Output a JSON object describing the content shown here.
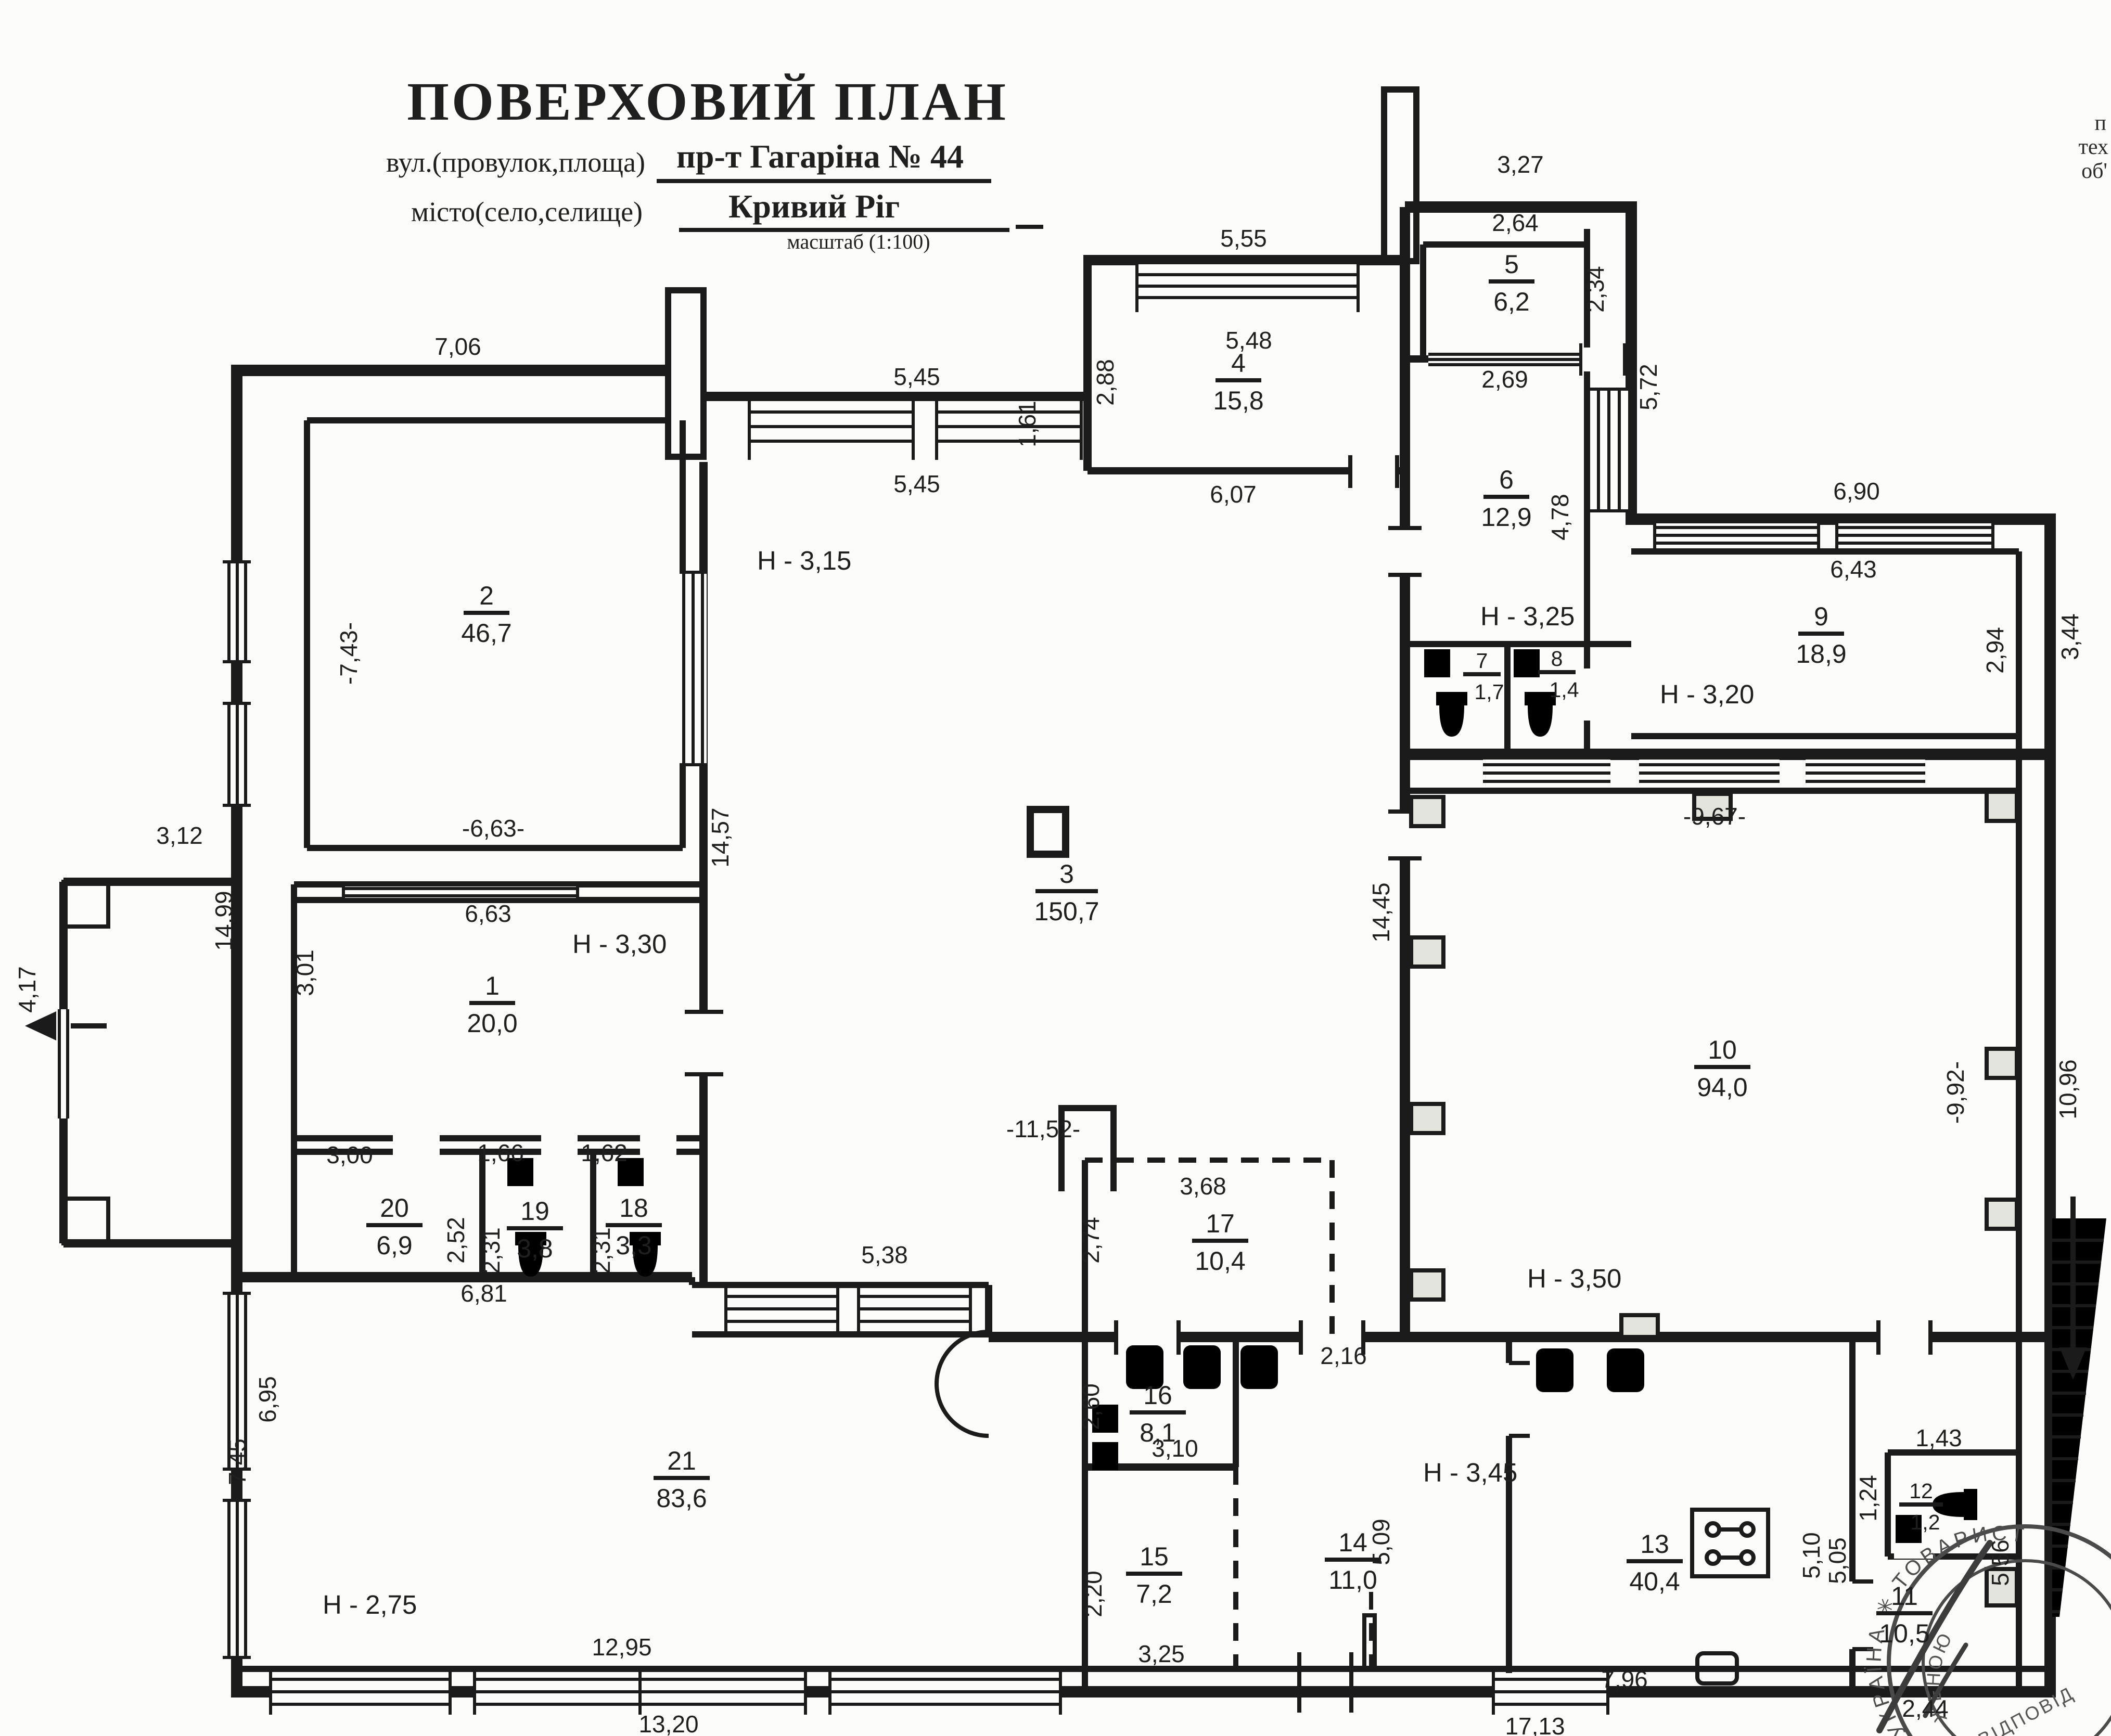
{
  "title_block": {
    "title": "ПОВЕРХОВИЙ ПЛАН",
    "street_label": "вул.(провулок,площа)",
    "street_value": "пр-т Гагаріна  №  44",
    "city_label": "місто(село,селище)",
    "city_value": "Кривий Ріг",
    "scale_note": "масштаб (1:100)"
  },
  "corner_note": {
    "line1": "п",
    "line2": "тех",
    "line3": "об'"
  },
  "rooms": {
    "r1": {
      "num": "1",
      "area": "20,0"
    },
    "r2": {
      "num": "2",
      "area": "46,7"
    },
    "r3": {
      "num": "3",
      "area": "150,7"
    },
    "r4": {
      "num": "4",
      "area": "15,8"
    },
    "r5": {
      "num": "5",
      "area": "6,2"
    },
    "r6": {
      "num": "6",
      "area": "12,9"
    },
    "r7": {
      "num": "7",
      "area": "1,7"
    },
    "r8": {
      "num": "8",
      "area": "1,4"
    },
    "r9": {
      "num": "9",
      "area": "18,9"
    },
    "r10": {
      "num": "10",
      "area": "94,0"
    },
    "r11": {
      "num": "11",
      "area": "10,5"
    },
    "r12": {
      "num": "12",
      "area": "1,2"
    },
    "r13": {
      "num": "13",
      "area": "40,4"
    },
    "r14": {
      "num": "14",
      "area": "11,0"
    },
    "r15": {
      "num": "15",
      "area": "7,2"
    },
    "r16": {
      "num": "16",
      "area": "8,1"
    },
    "r17": {
      "num": "17",
      "area": "10,4"
    },
    "r18": {
      "num": "18",
      "area": "3,3"
    },
    "r19": {
      "num": "19",
      "area": "3,8"
    },
    "r20": {
      "num": "20",
      "area": "6,9"
    },
    "r21": {
      "num": "21",
      "area": "83,6"
    }
  },
  "heights": {
    "h1": "Н - 3,30",
    "h3": "Н - 3,15",
    "h78": "Н - 3,25",
    "h9": "Н - 3,20",
    "h10": "Н - 3,50",
    "h14": "Н - 3,45",
    "h21": "Н - 2,75"
  },
  "dims": {
    "top_7_06": "7,06",
    "r3w_5_45a": "5,45",
    "r3w_5_45b": "5,45",
    "r4_5_55": "5,55",
    "r4_5_48": "5,48",
    "r4_6_07": "6,07",
    "r4_2_88": "2,88",
    "r4_1_61": "1,61",
    "r5_3_27": "3,27",
    "r5_2_64": "2,64",
    "r5_2_34": "2,34",
    "r6_2_69": "2,69",
    "wing_5_72": "5,72",
    "r6_4_78": "4,78",
    "r9_6_90": "6,90",
    "r9_6_43": "6,43",
    "r9_2_94": "2,94",
    "r9_3_44": "3,44",
    "r10_9_67": "-9,67-",
    "r10_9_92": "-9,92-",
    "r10_10_96": "10,96",
    "r3_14_45": "14,45",
    "r3_14_57": "14,57",
    "r3_11_52": "-11,52-",
    "r2_7_43": "-7,43-",
    "r2_6_63": "-6,63-",
    "r1_6_63": "6,63",
    "r1_3_01": "3,01",
    "porch_3_12": "3,12",
    "porch_4_17": "4,17",
    "left_14_99": "14,99",
    "r20_3_00": "3,00",
    "r19_1_66": "1,66",
    "r18_1_62": "1,62",
    "r20_2_52": "2,52",
    "r19_2_31": "2,31",
    "r18_2_31": "2,31",
    "r17_3_68": "3,68",
    "r17_2_74": "2,74",
    "band_5_38": "5,38",
    "r21_6_81": "6,81",
    "c_2_16": "2,16",
    "r16_2_60": "2,60",
    "r16_3_10": "3,10",
    "r15_2_20": "2,20",
    "r15_3_25": "3,25",
    "r14_5_09": "5,09",
    "r21_6_95": "6,95",
    "r21_7_45": "7,45",
    "r21_12_95": "12,95",
    "r21_13_20": "13,20",
    "r13_5_10": "5,10",
    "r13_5_05": "5,05",
    "r12_1_43": "1,43",
    "r12_1_24": "1,24",
    "r13_7_96": "7,96",
    "r11_2_44": "2,44",
    "bot_17_13": "17,13",
    "st_5_56": "5,56"
  },
  "stamp": {
    "ring": "УКРАЇНА  ✳  ТОВАРИСТВО",
    "line1": "З ОБМЕЖЕНОЮ",
    "line2": "ВІДПОВІД"
  }
}
